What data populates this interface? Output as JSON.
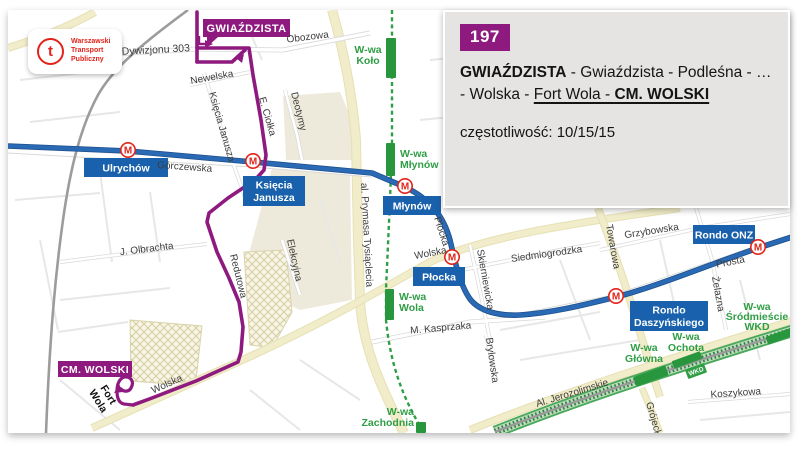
{
  "logo": {
    "glyph": "t",
    "brand_lines": [
      "Warszawski",
      "Transport",
      "Publiczny"
    ]
  },
  "panel": {
    "line_number": "197",
    "route_parts": {
      "start": "GWIAŹDZISTA",
      "middle": " - Gwiaździsta - Podleśna - … - Wolska - ",
      "underlined": "Fort Wola - ",
      "end": "CM. WOLSKI"
    },
    "frequency_label": "częstotliwość:",
    "frequency_value": "10/15/15"
  },
  "map": {
    "terminals": {
      "start": "GWIAŹDZISTA",
      "end": "CM. WOLSKI"
    },
    "route_annotations": {
      "fort_wola": [
        "Fort",
        "Wola"
      ]
    },
    "metro_icon_letter": "M",
    "metro_stations": [
      {
        "name": "Ulrychów",
        "lines": [
          "Ulrychów"
        ]
      },
      {
        "name": "Księcia Janusza",
        "lines": [
          "Księcia",
          "Janusza"
        ]
      },
      {
        "name": "Młynów",
        "lines": [
          "Młynów"
        ]
      },
      {
        "name": "Płocka",
        "lines": [
          "Płocka"
        ]
      },
      {
        "name": "Rondo Daszyńskiego",
        "lines": [
          "Rondo",
          "Daszyńskiego"
        ]
      },
      {
        "name": "Rondo ONZ",
        "lines": [
          "Rondo ONZ"
        ]
      }
    ],
    "rail_stations": [
      {
        "name": "W-wa Koło",
        "lines": [
          "W-wa",
          "Koło"
        ]
      },
      {
        "name": "W-wa Młynów",
        "lines": [
          "W-wa",
          "Młynów"
        ]
      },
      {
        "name": "W-wa Wola",
        "lines": [
          "W-wa",
          "Wola"
        ]
      },
      {
        "name": "W-wa Zachodnia",
        "lines": [
          "W-wa",
          "Zachodnia"
        ]
      },
      {
        "name": "W-wa Główna",
        "lines": [
          "W-wa",
          "Główna"
        ]
      },
      {
        "name": "W-wa Ochota",
        "lines": [
          "W-wa",
          "Ochota"
        ]
      },
      {
        "name": "W-wa Śródmieście WKD",
        "lines": [
          "W-wa",
          "Śródmieście",
          "WKD"
        ]
      }
    ],
    "rail_badge": "WKD",
    "streets": [
      {
        "name": "Obozowa"
      },
      {
        "name": "Dywizjonu 303"
      },
      {
        "name": "Deotymy"
      },
      {
        "name": "Newelska"
      },
      {
        "name": "Księcia Janusza"
      },
      {
        "name": "E. Ciołka"
      },
      {
        "name": "Górczewska"
      },
      {
        "name": "J. Olbrachta"
      },
      {
        "name": "Redutowa"
      },
      {
        "name": "Elekcyjna"
      },
      {
        "name": "al. Prymasa Tysiąclecia"
      },
      {
        "name": "Wolska"
      },
      {
        "name": "Płocka"
      },
      {
        "name": "Skierniewicka"
      },
      {
        "name": "Siedmiogrodzka"
      },
      {
        "name": "M. Kasprzaka"
      },
      {
        "name": "Brylowska"
      },
      {
        "name": "Towarowa"
      },
      {
        "name": "Grzybowska"
      },
      {
        "name": "Prosta"
      },
      {
        "name": "Żelazna"
      },
      {
        "name": "Al. Jerozolimskie"
      },
      {
        "name": "Koszykowa"
      },
      {
        "name": "Grójecka"
      },
      {
        "name": "Wolska"
      }
    ]
  },
  "colors": {
    "route_purple": "#8e1a7f",
    "metro_line_blue": "#2a6ab5",
    "metro_label_bg": "#1961ac",
    "metro_icon_red": "#e2231a",
    "rail_green": "#2f9e45",
    "panel_bg": "#e5e4e2",
    "brand_red": "#e2231a",
    "major_road_yellow": "#f1ecc9"
  }
}
